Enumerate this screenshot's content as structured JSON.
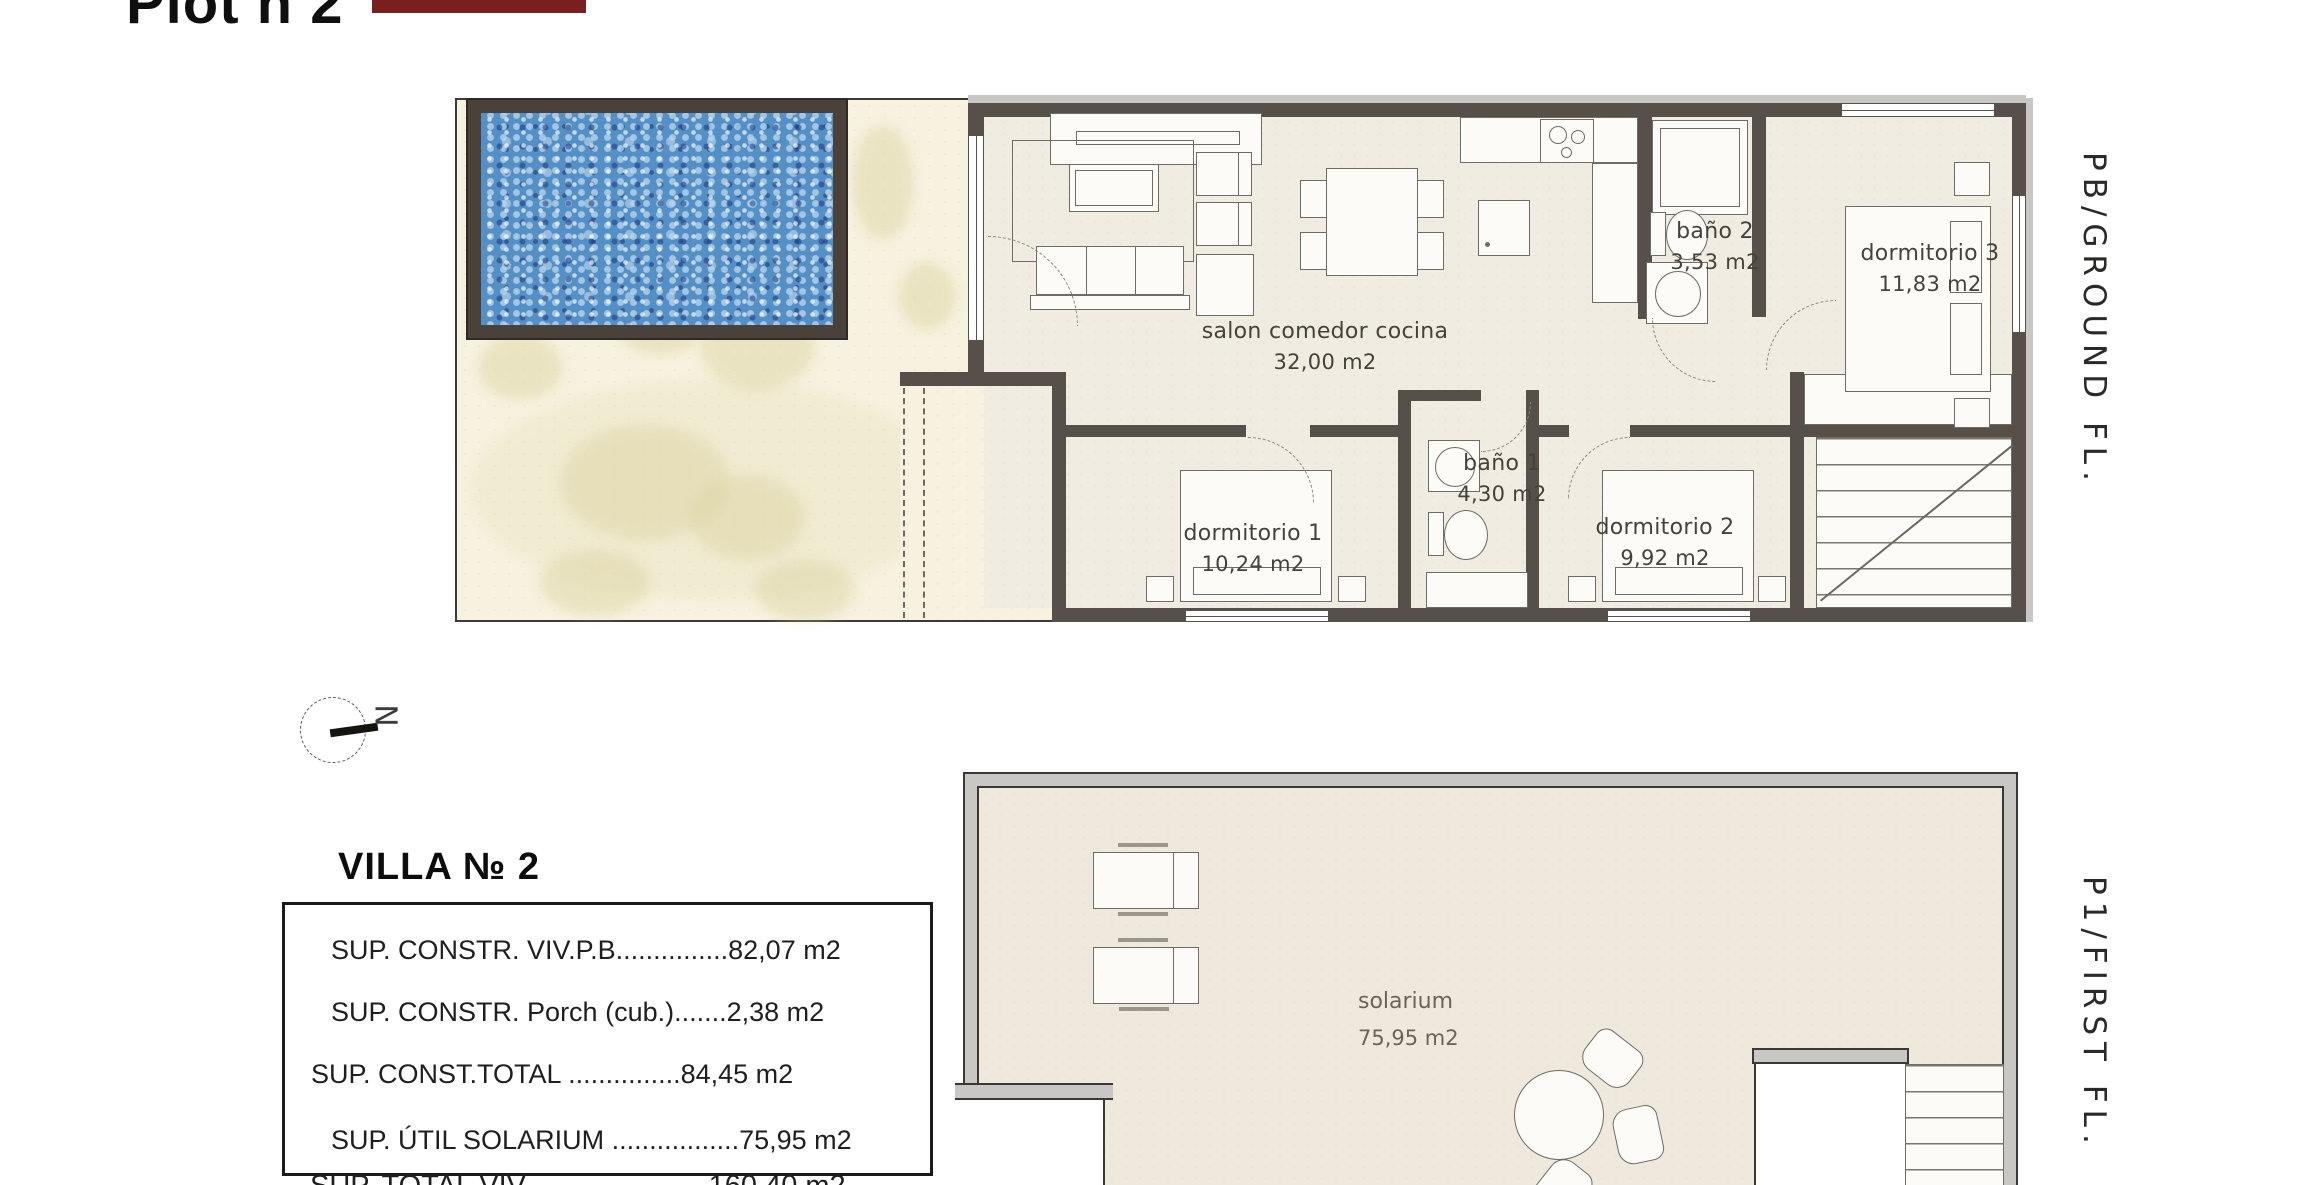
{
  "header": {
    "title": "Plot n 2"
  },
  "compass": {
    "letter": "N"
  },
  "ground_floor": {
    "side_label": "PB/GROUND FL.",
    "rooms": [
      {
        "name": "salon comedor cocina",
        "area": "32,00 m2"
      },
      {
        "name": "baño 2",
        "area": "3,53 m2"
      },
      {
        "name": "dormitorio 3",
        "area": "11,83 m2"
      },
      {
        "name": "dormitorio 1",
        "area": "10,24 m2"
      },
      {
        "name": "baño 1",
        "area": "4,30 m2"
      },
      {
        "name": "dormitorio 2",
        "area": "9,92 m2"
      }
    ]
  },
  "first_floor": {
    "side_label": "P1/FIRST FL.",
    "rooms": [
      {
        "name": "solarium",
        "area": "75,95 m2"
      }
    ]
  },
  "villa_summary": {
    "title": "VILLA № 2",
    "rows": [
      "SUP. CONSTR. VIV.P.B...............82,07 m2",
      "SUP. CONSTR. Porch (cub.).......2,38 m2",
      "SUP. CONST.TOTAL ...............84,45 m2",
      "SUP. ÚTIL SOLARIUM .................75,95 m2"
    ],
    "footer_row": "SUP. TOTAL VIV.......................160,40 m2"
  },
  "colors": {
    "wall": "#57504a",
    "wall-dark": "#3a3835",
    "wall-gray": "#c9c7c3",
    "floor": "#f1ece1",
    "garden": "#f7f2df",
    "stain": "#ddd5a5",
    "pool-frame": "#49413a",
    "pool-water": "#5490c6",
    "line": "#6e6c64",
    "label": "#44423c",
    "redaction": "#7a1f1f"
  }
}
